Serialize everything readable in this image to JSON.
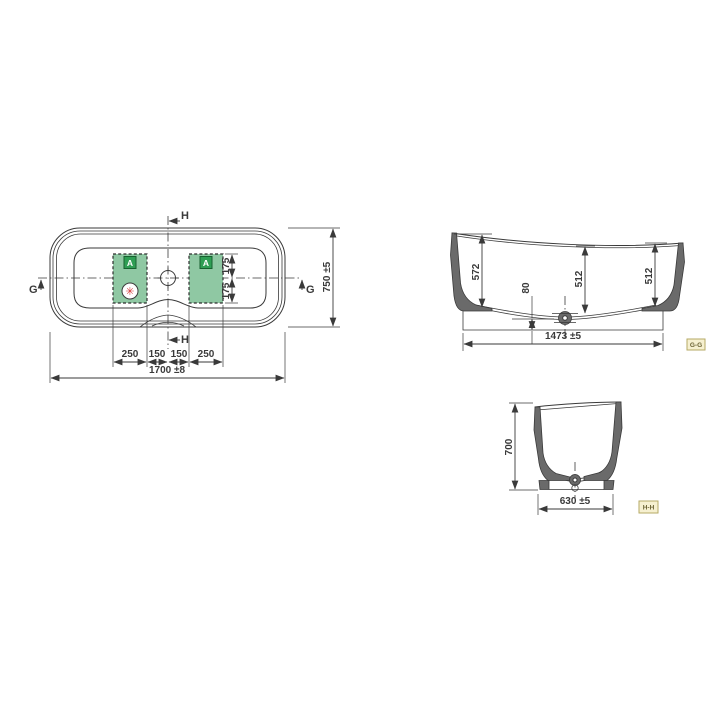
{
  "title": "bathtub-technical-drawing",
  "plan": {
    "markers": {
      "top": "H",
      "bottom": "H",
      "left": "G",
      "right": "G"
    },
    "dims": {
      "overall_length": "1700 ±8",
      "overall_width": "750 ±5",
      "seg_left_outer": "250",
      "seg_left_inner": "150",
      "seg_right_inner": "150",
      "seg_right_outer": "250",
      "offset_top": "175",
      "offset_bottom": "175"
    },
    "zone_badge": "A",
    "asterisk_glyph": "✳"
  },
  "section_gg": {
    "label": "G-G",
    "dims": {
      "height_left": "572",
      "height_mid": "512",
      "height_right": "512",
      "floor_offset": "80",
      "base_length": "1473 ±5"
    }
  },
  "section_hh": {
    "label": "H-H",
    "dims": {
      "height": "700",
      "base_width": "630 ±5"
    }
  },
  "colors": {
    "background": "#ffffff",
    "line": "#3a3a3a",
    "wall_fill": "#6a6a6a",
    "zone_fill": "#8fc8a3",
    "zone_border": "#2e2e2e",
    "badge_fill": "#2f9e54",
    "badge_border": "#17612f",
    "asterisk_red": "#d63b3b",
    "section_box_fill": "#f6f0d0",
    "section_box_border": "#b6aa66",
    "section_box_text": "#6a6233"
  }
}
